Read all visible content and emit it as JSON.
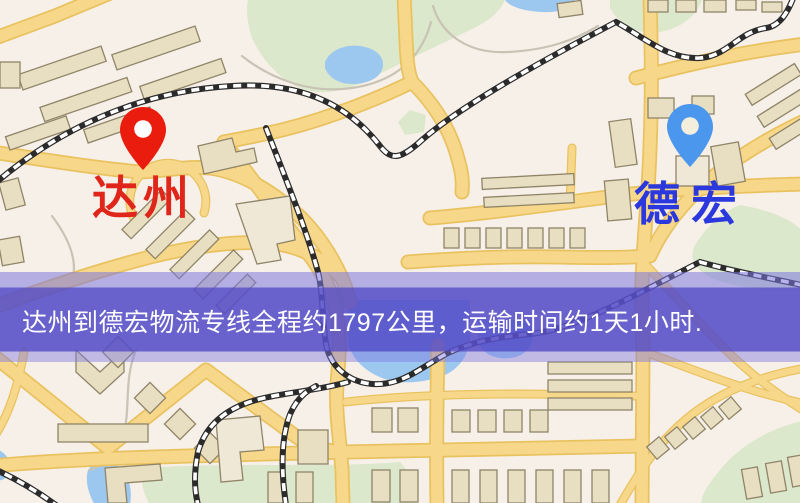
{
  "map": {
    "origin": {
      "label": "达州",
      "label_color": "#e0251a",
      "marker_color": "#ea1c0e"
    },
    "destination": {
      "label": "德宏",
      "label_color": "#2a38dd",
      "marker_color": "#4b97ee"
    },
    "banner": {
      "text": "达州到德宏物流专线全程约1797公里，运输时间约1天1小时.",
      "text_color": "#ffffff",
      "background_color": "#564fc7"
    },
    "route": {
      "distance_km": 1797,
      "duration": "1天1小时"
    },
    "legend_colors": {
      "background": "#f7f0e8",
      "road": "#f7d78a",
      "road_casing": "#e9c260",
      "water": "#9cc8f0",
      "park": "#dce8cb",
      "building": "#e8dfc2",
      "railway": "#2b2b2b"
    }
  }
}
